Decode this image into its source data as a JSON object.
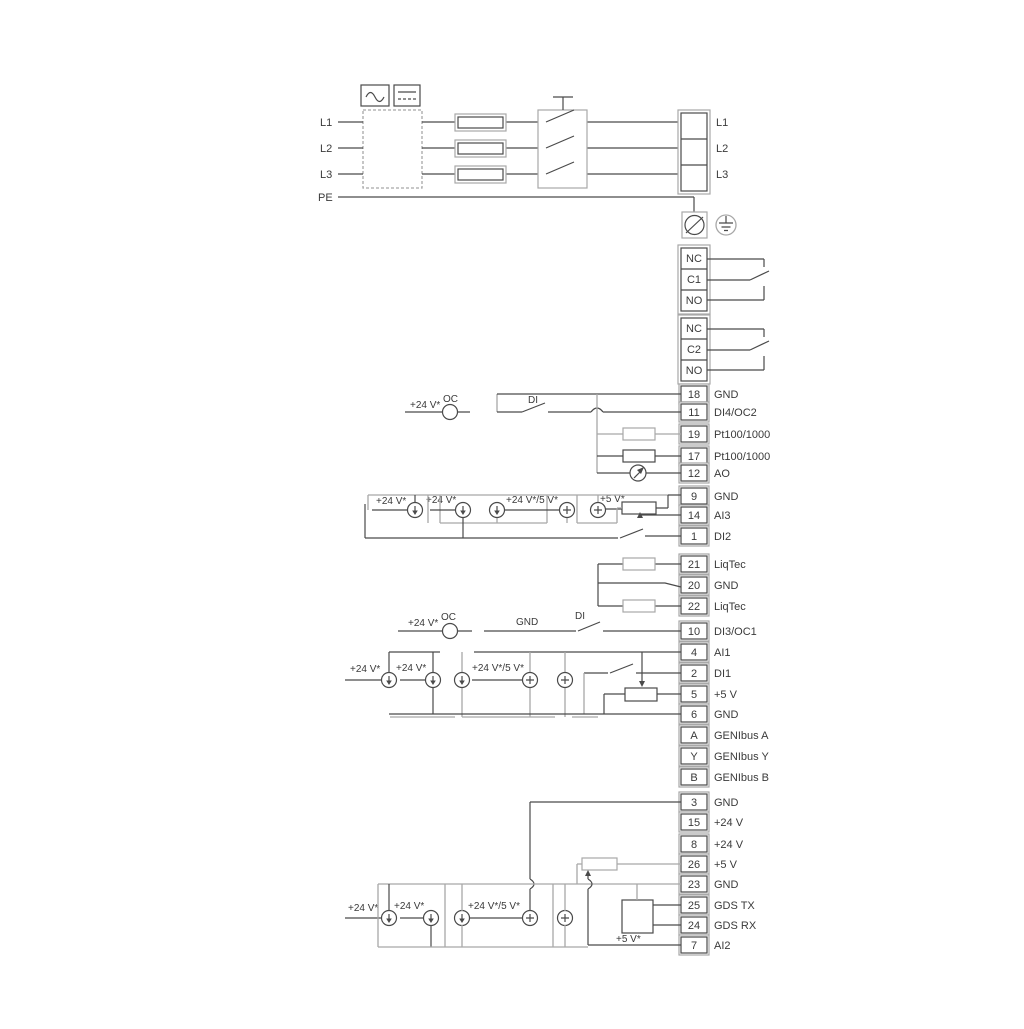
{
  "power": {
    "in": [
      "L1",
      "L2",
      "L3",
      "PE"
    ],
    "out": [
      "L1",
      "L2",
      "L3"
    ]
  },
  "relay1": [
    "NC",
    "C1",
    "NO"
  ],
  "relay2": [
    "NC",
    "C2",
    "NO"
  ],
  "io": [
    {
      "num": "18",
      "label": "GND"
    },
    {
      "num": "11",
      "label": "DI4/OC2"
    },
    {
      "num": "19",
      "label": "Pt100/1000"
    },
    {
      "num": "17",
      "label": "Pt100/1000"
    },
    {
      "num": "12",
      "label": "AO"
    },
    {
      "num": "9",
      "label": "GND"
    },
    {
      "num": "14",
      "label": "AI3"
    },
    {
      "num": "1",
      "label": "DI2"
    },
    {
      "num": "21",
      "label": "LiqTec"
    },
    {
      "num": "20",
      "label": "GND"
    },
    {
      "num": "22",
      "label": "LiqTec"
    },
    {
      "num": "10",
      "label": "DI3/OC1"
    },
    {
      "num": "4",
      "label": "AI1"
    },
    {
      "num": "2",
      "label": "DI1"
    },
    {
      "num": "5",
      "label": "+5 V"
    },
    {
      "num": "6",
      "label": "GND"
    },
    {
      "num": "A",
      "label": "GENIbus A"
    },
    {
      "num": "Y",
      "label": "GENIbus Y"
    },
    {
      "num": "B",
      "label": "GENIbus B"
    },
    {
      "num": "3",
      "label": "GND"
    },
    {
      "num": "15",
      "label": "+24 V"
    },
    {
      "num": "8",
      "label": "+24 V"
    },
    {
      "num": "26",
      "label": "+5 V"
    },
    {
      "num": "23",
      "label": "GND"
    },
    {
      "num": "25",
      "label": "GDS TX"
    },
    {
      "num": "24",
      "label": "GDS RX"
    },
    {
      "num": "7",
      "label": "AI2"
    }
  ],
  "labels": {
    "v24": "+24 V*",
    "v24or5": "+24 V*/5 V*",
    "v5": "+5 V*",
    "oc": "OC",
    "di": "DI",
    "gnd": "GND"
  },
  "colors": {
    "line": "#4a4a4a",
    "muted": "#a8a8a8"
  }
}
